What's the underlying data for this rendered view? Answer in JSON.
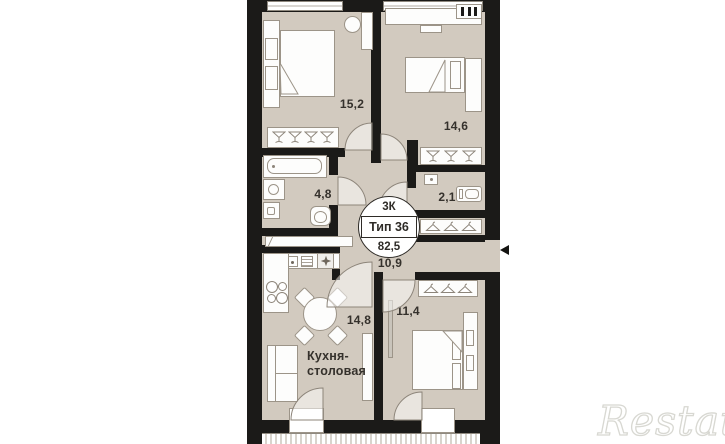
{
  "badge": {
    "rooms_label": "3К",
    "type_label": "Тип 36",
    "area_total": "82,5"
  },
  "rooms": {
    "bedroom1": {
      "area": "15,2"
    },
    "bedroom2": {
      "area": "14,6"
    },
    "bathroom": {
      "area": "4,8"
    },
    "wc": {
      "area": "2,1"
    },
    "hallway": {
      "area": "10,9"
    },
    "kitchen": {
      "area": "14,8",
      "name_line1": "Кухня-",
      "name_line2": "столовая"
    },
    "bedroom3": {
      "area": "11,4"
    }
  },
  "watermark": {
    "text": "Restate"
  },
  "colors": {
    "wall": "#1b1a18",
    "floor": "#d2cabf",
    "furniture_outline": "#9c9488"
  }
}
